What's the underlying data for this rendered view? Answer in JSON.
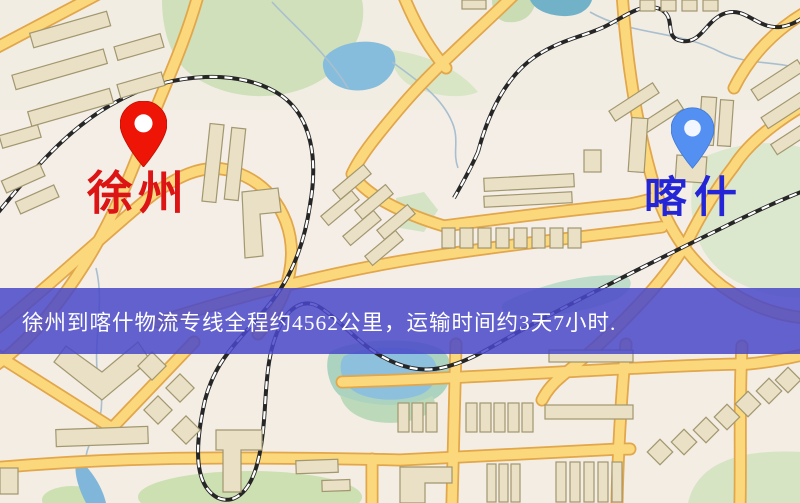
{
  "map": {
    "origin": {
      "label": "徐州"
    },
    "destination": {
      "label": "喀什"
    },
    "banner": {
      "text": "徐州到喀什物流专线全程约4562公里，运输时间约3天7小时."
    }
  },
  "colors": {
    "map-bg": "#f2ede2",
    "origin-pin": "#ee1506",
    "origin-label": "#dc1414",
    "dest-pin": "#5390f2",
    "dest-label": "#2425d6",
    "banner-bg": "rgba(73,72,201,0.85)",
    "banner-text": "#ffffff",
    "road-fill": "#fbd87c",
    "road-casing": "#e2a64b",
    "park": "#cfe0ba",
    "water": "#86bddd",
    "building": "#e9e0c6",
    "building-outline": "#a2976f",
    "railway": "#262626"
  }
}
